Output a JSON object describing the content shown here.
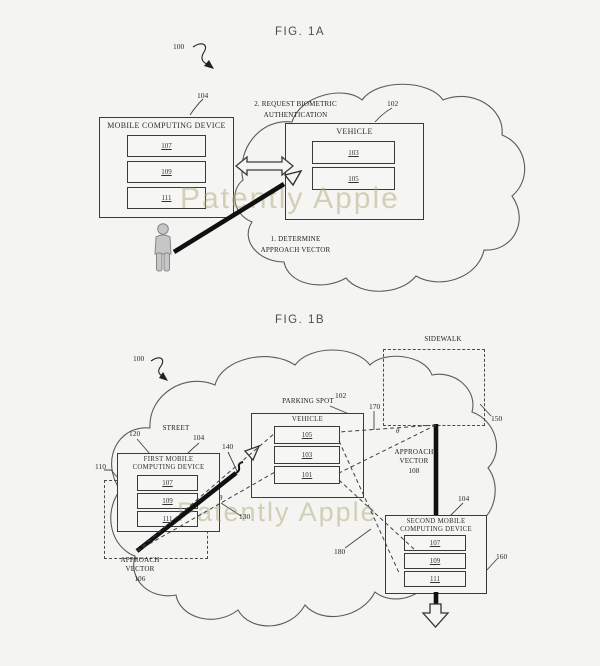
{
  "page": {
    "background": "#f4f4f2",
    "watermark": "Patently Apple",
    "watermark_color": "#b0aa7a",
    "line_color": "#3a3a3a"
  },
  "fig1a": {
    "title": "FIG. 1A",
    "labels": {
      "n100": "100",
      "n104": "104",
      "n102": "102"
    },
    "device": {
      "title": "MOBILE COMPUTING DEVICE",
      "modules": [
        "107",
        "109",
        "111"
      ]
    },
    "vehicle": {
      "title": "VEHICLE",
      "modules": [
        "103",
        "105"
      ]
    },
    "request_line1": "2. REQUEST BIOMETRIC",
    "request_line2": "AUTHENTICATION",
    "determine_line1": "1. DETERMINE",
    "determine_line2": "APPROACH VECTOR"
  },
  "fig1b": {
    "title": "FIG. 1B",
    "labels": {
      "n100": "100",
      "n102": "102",
      "n104_first": "104",
      "n104_second": "104",
      "n110": "110",
      "n120": "120",
      "n130": "130",
      "n140": "140",
      "n150": "150",
      "n160": "160",
      "n170": "170",
      "n180": "180",
      "theta": "θ"
    },
    "street": "STREET",
    "sidewalk": "SIDEWALK",
    "parking_spot": "PARKING SPOT",
    "first_device": {
      "title_line1": "FIRST MOBILE",
      "title_line2": "COMPUTING DEVICE",
      "modules": [
        "107",
        "109",
        "111"
      ]
    },
    "vehicle": {
      "title": "VEHICLE",
      "modules": [
        "105",
        "103",
        "101"
      ]
    },
    "second_device": {
      "title_line1": "SECOND MOBILE",
      "title_line2": "COMPUTING DEVICE",
      "modules": [
        "107",
        "109",
        "111"
      ]
    },
    "av106_line1": "APPROACH",
    "av106_line2": "VECTOR",
    "av106_line3": "106",
    "av108_line1": "APPROACH",
    "av108_line2": "VECTOR",
    "av108_line3": "108"
  }
}
